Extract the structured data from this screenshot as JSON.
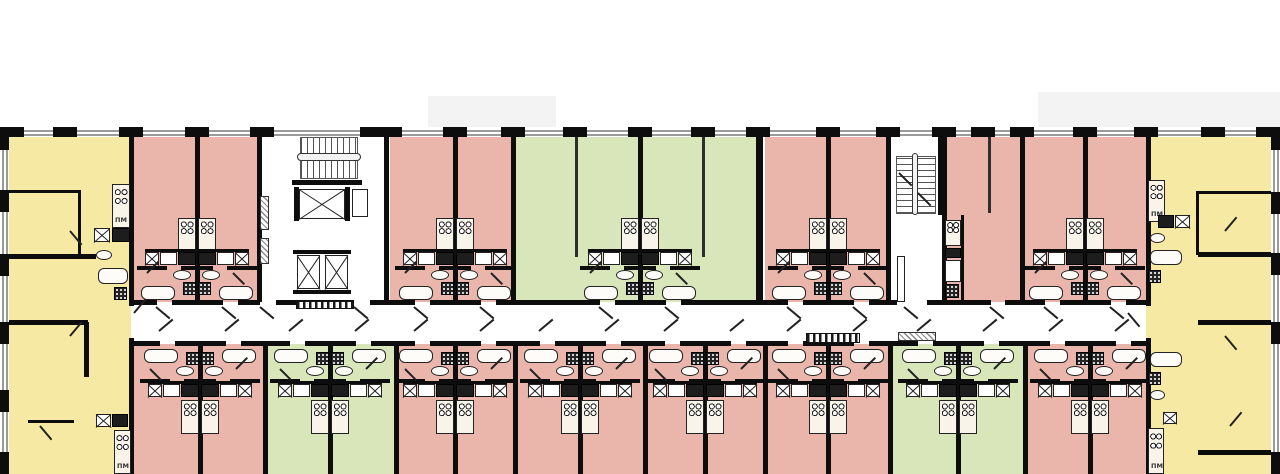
{
  "title": "residential-floor-plan",
  "labels": {
    "washer": "ПМ"
  },
  "colors": {
    "yellow": "#f6e9a4",
    "pink": "#eab6ac",
    "green": "#d9e6ba",
    "wall": "#0d0d0d",
    "window_line": "#9a9a9a",
    "paper": "#ffffff",
    "slab_shadow": "#f3f3f3"
  },
  "plan": {
    "canvas": {
      "w": 1280,
      "h": 474
    },
    "building": {
      "x": 0,
      "y": 128,
      "w": 1280,
      "h": 346
    },
    "corridor": {
      "x": 131,
      "y": 302,
      "w": 1015,
      "h": 42
    },
    "slab_shadows": [
      [
        428,
        96,
        128,
        32
      ],
      [
        1038,
        92,
        242,
        36
      ]
    ],
    "corner_units": [
      {
        "x": 0,
        "w": 131,
        "color": "yellow"
      },
      {
        "x": 1146,
        "w": 134,
        "color": "yellow"
      }
    ],
    "units_top": [
      {
        "x": 131,
        "w": 66,
        "color": "pink"
      },
      {
        "x": 197,
        "w": 62,
        "color": "pink"
      },
      {
        "x": 390,
        "w": 65,
        "color": "pink"
      },
      {
        "x": 455,
        "w": 58,
        "color": "pink"
      },
      {
        "x": 513,
        "w": 127,
        "color": "green"
      },
      {
        "x": 640,
        "w": 118,
        "color": "green"
      },
      {
        "x": 765,
        "w": 63,
        "color": "pink"
      },
      {
        "x": 828,
        "w": 60,
        "color": "pink"
      },
      {
        "x": 944,
        "w": 78,
        "color": "pink"
      },
      {
        "x": 1022,
        "w": 63,
        "color": "pink"
      },
      {
        "x": 1085,
        "w": 61,
        "color": "pink"
      }
    ],
    "units_bottom": [
      {
        "x": 133,
        "w": 67,
        "color": "pink"
      },
      {
        "x": 200,
        "w": 65,
        "color": "pink"
      },
      {
        "x": 265,
        "w": 65,
        "color": "green"
      },
      {
        "x": 330,
        "w": 66,
        "color": "green"
      },
      {
        "x": 396,
        "w": 59,
        "color": "pink"
      },
      {
        "x": 455,
        "w": 60,
        "color": "pink"
      },
      {
        "x": 515,
        "w": 65,
        "color": "pink"
      },
      {
        "x": 580,
        "w": 65,
        "color": "pink"
      },
      {
        "x": 645,
        "w": 60,
        "color": "pink"
      },
      {
        "x": 705,
        "w": 60,
        "color": "pink"
      },
      {
        "x": 765,
        "w": 63,
        "color": "pink"
      },
      {
        "x": 828,
        "w": 62,
        "color": "pink"
      },
      {
        "x": 890,
        "w": 68,
        "color": "green"
      },
      {
        "x": 958,
        "w": 67,
        "color": "green"
      },
      {
        "x": 1025,
        "w": 65,
        "color": "pink"
      },
      {
        "x": 1090,
        "w": 56,
        "color": "pink"
      }
    ],
    "boundaries_top": [
      197,
      259,
      386,
      455,
      513,
      640,
      758,
      828,
      888,
      944,
      1022,
      1085
    ],
    "boundaries_bottom": [
      200,
      265,
      330,
      396,
      455,
      515,
      580,
      645,
      705,
      765,
      828,
      890,
      958,
      1025,
      1090
    ],
    "corner_walls": [
      129,
      1146
    ],
    "partitions": [
      [
        575,
        135,
        122
      ],
      [
        702,
        135,
        122
      ],
      [
        988,
        135,
        78
      ]
    ],
    "pairs_top": [
      197,
      455,
      640,
      828,
      1085
    ],
    "pairs_bottom": [
      200,
      330,
      455,
      580,
      705,
      828,
      958,
      1090
    ],
    "gaps_top_extra": [
      [
        268,
        16
      ],
      [
        362,
        16
      ],
      [
        912,
        30
      ],
      [
        998,
        14
      ]
    ],
    "top_piers": [
      0,
      65,
      131,
      197,
      262,
      372,
      390,
      455,
      513,
      575,
      640,
      703,
      758,
      828,
      888,
      944,
      983,
      1022,
      1085,
      1146,
      1213,
      1272
    ],
    "left_piers": [
      128,
      190,
      254,
      322,
      390,
      452
    ],
    "right_piers": [
      128,
      192,
      253,
      322,
      452
    ],
    "walls_extra": [
      [
        0,
        190,
        80,
        3
      ],
      [
        78,
        190,
        3,
        66
      ],
      [
        0,
        254,
        96,
        5
      ],
      [
        0,
        320,
        88,
        5
      ],
      [
        84,
        322,
        5,
        55
      ],
      [
        28,
        420,
        46,
        3
      ],
      [
        1198,
        191,
        82,
        3
      ],
      [
        1196,
        191,
        3,
        64
      ],
      [
        1198,
        252,
        82,
        5
      ],
      [
        1198,
        320,
        82,
        5
      ],
      [
        1198,
        450,
        82,
        5
      ],
      [
        292,
        180,
        70,
        5
      ],
      [
        293,
        250,
        58,
        4
      ],
      [
        293,
        290,
        58,
        4
      ],
      [
        938,
        130,
        5,
        85
      ],
      [
        961,
        215,
        3,
        88
      ]
    ],
    "fixtures": [
      [
        "stovev",
        112,
        184,
        18,
        44,
        "washer"
      ],
      [
        "xbox",
        94,
        228,
        16,
        14
      ],
      [
        "darkbox",
        112,
        228,
        18,
        14
      ],
      [
        "oval",
        96,
        250,
        16,
        10
      ],
      [
        "tub",
        98,
        268,
        30,
        16
      ],
      [
        "shower",
        114,
        287,
        13,
        13
      ],
      [
        "xbox",
        96,
        414,
        15,
        13
      ],
      [
        "darkbox",
        112,
        414,
        16,
        13
      ],
      [
        "stovev",
        114,
        430,
        17,
        44,
        "washer"
      ],
      [
        "stovev",
        1148,
        180,
        17,
        42,
        "washer"
      ],
      [
        "darkbox",
        1158,
        215,
        16,
        13
      ],
      [
        "xbox",
        1175,
        215,
        15,
        13
      ],
      [
        "oval",
        1150,
        233,
        15,
        10
      ],
      [
        "tub",
        1150,
        250,
        32,
        15
      ],
      [
        "shower",
        1148,
        270,
        13,
        13
      ],
      [
        "tub",
        1150,
        352,
        32,
        15
      ],
      [
        "shower",
        1148,
        372,
        13,
        13
      ],
      [
        "oval",
        1150,
        390,
        15,
        10
      ],
      [
        "xbox",
        1163,
        412,
        14,
        12
      ],
      [
        "stovev",
        1148,
        428,
        16,
        46,
        "washer"
      ],
      [
        "stairsH",
        300,
        137,
        58,
        42
      ],
      [
        "rail",
        297,
        153,
        64,
        8
      ],
      [
        "elev",
        299,
        189,
        46,
        30
      ],
      [
        "wall",
        294,
        187,
        5,
        34
      ],
      [
        "wall",
        345,
        187,
        5,
        34
      ],
      [
        "whitebox",
        352,
        189,
        16,
        28
      ],
      [
        "elev",
        297,
        255,
        23,
        34
      ],
      [
        "elev",
        325,
        255,
        23,
        34
      ],
      [
        "hatch",
        260,
        196,
        9,
        34
      ],
      [
        "hatch",
        260,
        238,
        9,
        26
      ],
      [
        "stripes",
        296,
        301,
        58,
        8
      ],
      [
        "stairsV",
        896,
        156,
        40,
        58
      ],
      [
        "rail",
        912,
        153,
        6,
        62
      ],
      [
        "line",
        899,
        172,
        18,
        45
      ],
      [
        "line",
        918,
        192,
        18,
        45
      ],
      [
        "whitebox",
        897,
        256,
        8,
        46
      ],
      [
        "hatch",
        898,
        332,
        38,
        9
      ],
      [
        "stripes",
        806,
        333,
        54,
        10
      ],
      [
        "stove",
        945,
        220,
        16,
        26
      ],
      [
        "darkbox",
        945,
        248,
        16,
        10
      ],
      [
        "whitebox",
        945,
        260,
        16,
        22
      ],
      [
        "shower",
        945,
        284,
        14,
        14
      ]
    ],
    "swings_extra": [
      [
        70,
        230,
        50
      ],
      [
        70,
        335,
        -50
      ],
      [
        40,
        425,
        50
      ],
      [
        1225,
        230,
        -50
      ],
      [
        1225,
        335,
        50
      ],
      [
        1230,
        425,
        -50
      ],
      [
        134,
        312,
        -50
      ],
      [
        1128,
        312,
        50
      ]
    ]
  }
}
